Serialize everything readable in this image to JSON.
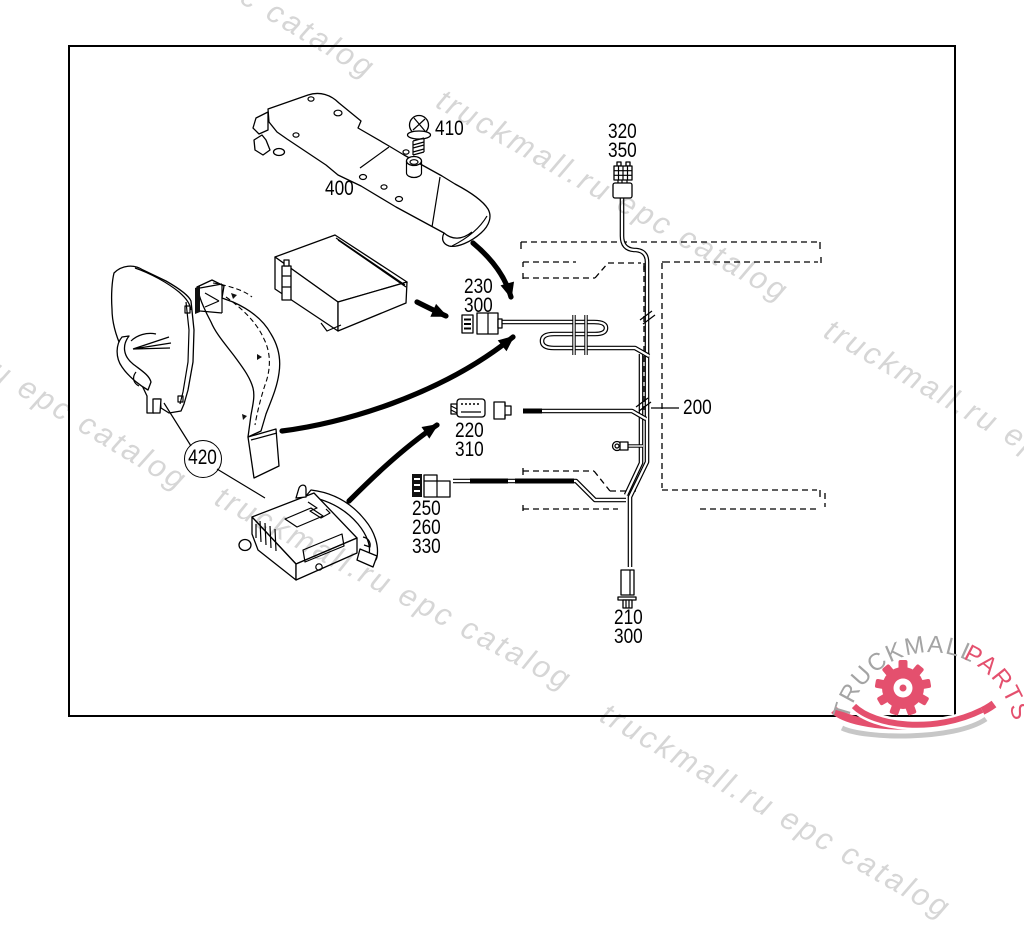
{
  "watermark": {
    "text": "truckmall.ru epc catalog",
    "color": "#d6d6d6"
  },
  "logo": {
    "word1": "TRUCKMALL",
    "word2": "PARTS",
    "word1_color": "#a4a4a4",
    "word2_color": "#e4506e",
    "gear_color": "#e4506e",
    "swoosh_gray": "#c7c7c7"
  },
  "callouts": {
    "screw": "410",
    "duct": "400",
    "pillar_trim": "420",
    "harness": "200",
    "conn_top": {
      "l1": "320",
      "l2": "350"
    },
    "conn_mid": {
      "l1": "230",
      "l2": "300"
    },
    "conn_lower": {
      "l1": "220",
      "l2": "310"
    },
    "conn_radio": {
      "l1": "250",
      "l2": "260",
      "l3": "330"
    },
    "conn_bottom": {
      "l1": "210",
      "l2": "300"
    }
  }
}
